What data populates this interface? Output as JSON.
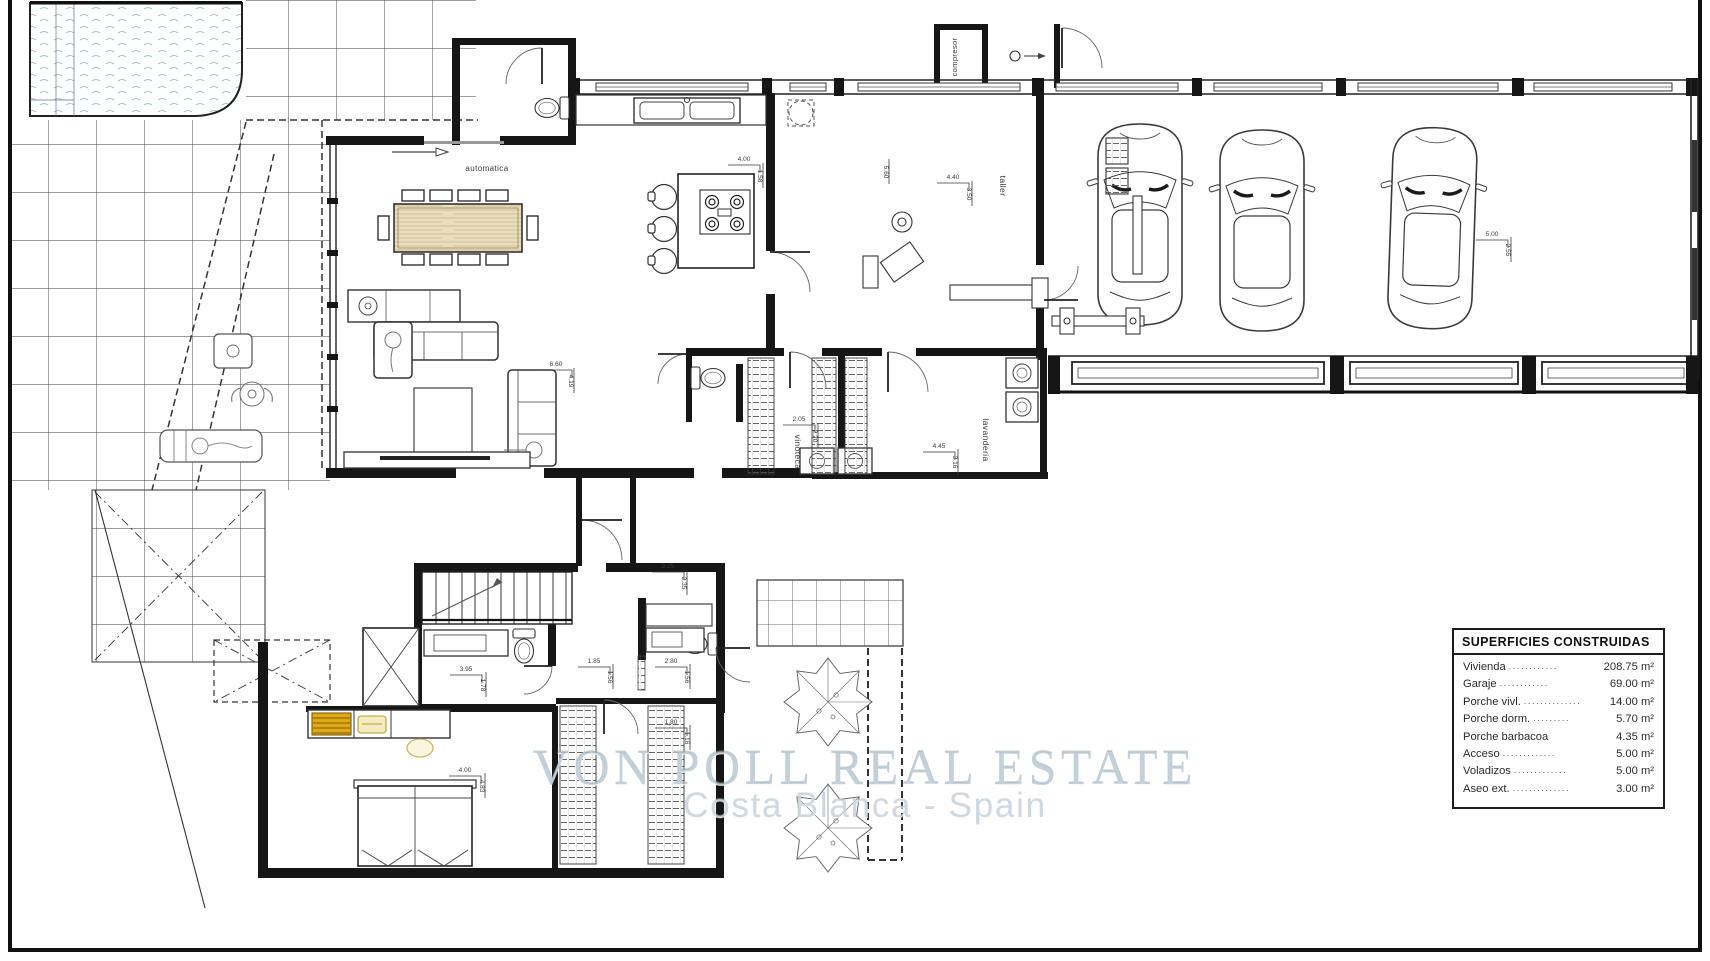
{
  "watermark": {
    "line1": "VON POLL REAL ESTATE",
    "line2": "Costa Blanca - Spain"
  },
  "areas_table": {
    "title": "SUPERFICIES CONSTRUIDAS",
    "rows": [
      {
        "label": "Vivienda",
        "dots": "............",
        "value": "208.75 m²"
      },
      {
        "label": "Garaje",
        "dots": "............",
        "value": "69.00 m²"
      },
      {
        "label": "Porche vivl.",
        "dots": "..............",
        "value": "14.00 m²"
      },
      {
        "label": "Porche dorm.",
        "dots": ".........",
        "value": "5.70 m²"
      },
      {
        "label": "Porche barbacoa",
        "dots": "",
        "value": "4.35 m²"
      },
      {
        "label": "Acceso",
        "dots": ".............",
        "value": "5.00 m²"
      },
      {
        "label": "Voladizos",
        "dots": ".............",
        "value": "5.00 m²"
      },
      {
        "label": "Aseo ext.",
        "dots": "..............",
        "value": "3.00 m²"
      }
    ]
  },
  "room_labels": [
    {
      "text": "compresor",
      "x": 957,
      "y": 57,
      "rot": -90,
      "size": 7.5
    },
    {
      "text": "taller",
      "x": 1000,
      "y": 186,
      "rot": 90,
      "size": 8.5
    },
    {
      "text": "automatica",
      "x": 487,
      "y": 171,
      "rot": 0,
      "size": 8
    },
    {
      "text": "vinoteca",
      "x": 795,
      "y": 452,
      "rot": 90,
      "size": 8.5
    },
    {
      "text": "lavanderia",
      "x": 983,
      "y": 440,
      "rot": 90,
      "size": 8.5
    }
  ],
  "dim_labels": [
    {
      "text": "4.00",
      "x": 744,
      "y": 161,
      "rot": 0
    },
    {
      "text": "1.58",
      "x": 758,
      "y": 176,
      "rot": 90
    },
    {
      "text": "4.40",
      "x": 953,
      "y": 179,
      "rot": 0
    },
    {
      "text": "3.50",
      "x": 967,
      "y": 194,
      "rot": 90
    },
    {
      "text": "5.60",
      "x": 884,
      "y": 172,
      "rot": 90
    },
    {
      "text": "6.60",
      "x": 556,
      "y": 366,
      "rot": 0
    },
    {
      "text": "4.19",
      "x": 569,
      "y": 381,
      "rot": 90
    },
    {
      "text": "2.05",
      "x": 799,
      "y": 421,
      "rot": 0
    },
    {
      "text": "2.20",
      "x": 813,
      "y": 436,
      "rot": 90
    },
    {
      "text": "4.45",
      "x": 939,
      "y": 448,
      "rot": 0
    },
    {
      "text": "3.16",
      "x": 953,
      "y": 462,
      "rot": 90
    },
    {
      "text": "3.25",
      "x": 668,
      "y": 568,
      "rot": 0
    },
    {
      "text": "2.35",
      "x": 682,
      "y": 583,
      "rot": 90
    },
    {
      "text": "3.95",
      "x": 466,
      "y": 671,
      "rot": 0
    },
    {
      "text": "1.78",
      "x": 481,
      "y": 685,
      "rot": 90
    },
    {
      "text": "1.85",
      "x": 594,
      "y": 663,
      "rot": 0
    },
    {
      "text": "1.56",
      "x": 608,
      "y": 677,
      "rot": 90
    },
    {
      "text": "2.80",
      "x": 671,
      "y": 663,
      "rot": 0
    },
    {
      "text": "1.56",
      "x": 685,
      "y": 677,
      "rot": 90
    },
    {
      "text": "1.80",
      "x": 671,
      "y": 724,
      "rot": 0
    },
    {
      "text": "1.16",
      "x": 685,
      "y": 738,
      "rot": 90
    },
    {
      "text": "4.00",
      "x": 465,
      "y": 772,
      "rot": 0
    },
    {
      "text": "4.83",
      "x": 480,
      "y": 786,
      "rot": 90
    },
    {
      "text": "5.00",
      "x": 1492,
      "y": 236,
      "rot": 0
    },
    {
      "text": "2.55",
      "x": 1506,
      "y": 250,
      "rot": 90
    }
  ],
  "colors": {
    "line": "#1c1c1c",
    "watermark": "#a4b7c4",
    "drawer_yellow": "#e2ab15",
    "pale_yellow": "#f4ecc0",
    "wood": "#eadfbd"
  }
}
